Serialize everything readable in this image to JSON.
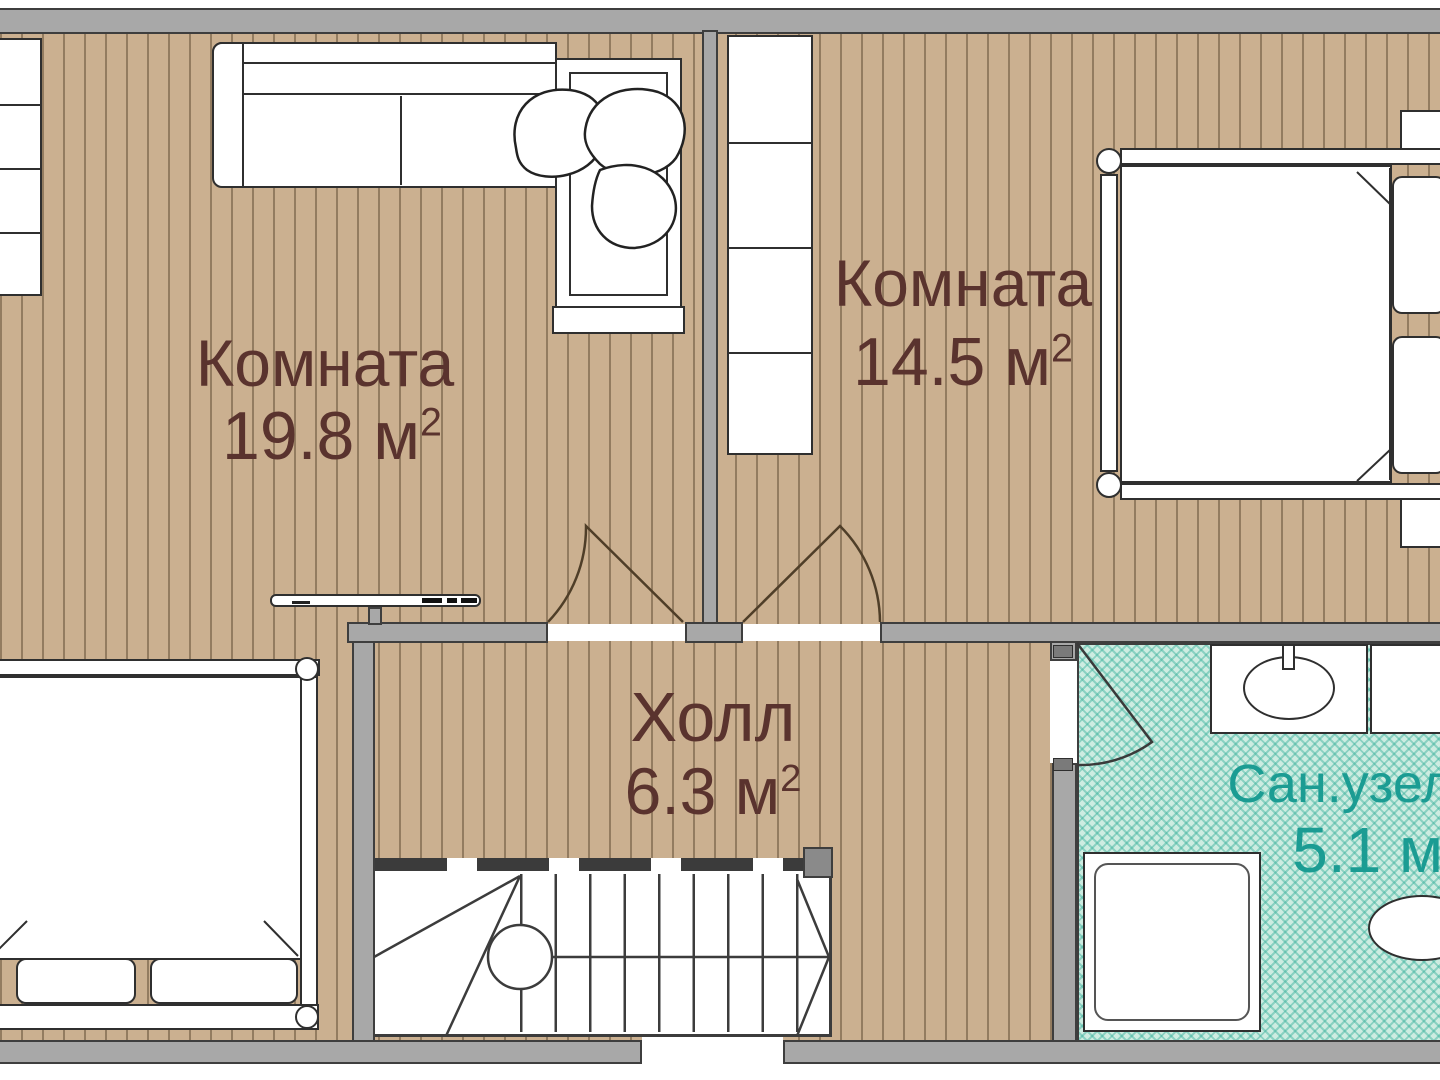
{
  "plan": {
    "title": "apartment-floor-plan-upper-level",
    "rooms": [
      {
        "name": "Комната",
        "area": "19.8 м",
        "area_sup": "2"
      },
      {
        "name": "Комната",
        "area": "14.5 м",
        "area_sup": "2"
      },
      {
        "name": "Холл",
        "area": "6.3 м",
        "area_sup": "2"
      },
      {
        "name": "Сан.узел",
        "area": "5.1 м",
        "area_sup": "2"
      }
    ],
    "colors": {
      "wood_floor": "#cbb090",
      "plank_line": "#5c4830",
      "wall_fill": "#a8a8a8",
      "wall_outline": "#3e3e3e",
      "bath_floor": "#cdece1",
      "bath_hatch": "#39b09b",
      "room_label": "#5a332e",
      "bath_label": "#1b9c93",
      "furniture_outline": "#2f2f2f"
    },
    "icons": [
      "corner-sofa-icon",
      "plant-icon",
      "tv-icon",
      "double-bed-icon",
      "double-bed-icon",
      "wardrobe-icon",
      "shelf-unit-icon",
      "nightstand-icon",
      "stairs-icon",
      "door-swing-icon",
      "shower-tray-icon",
      "sink-vanity-icon",
      "toilet-icon"
    ]
  }
}
